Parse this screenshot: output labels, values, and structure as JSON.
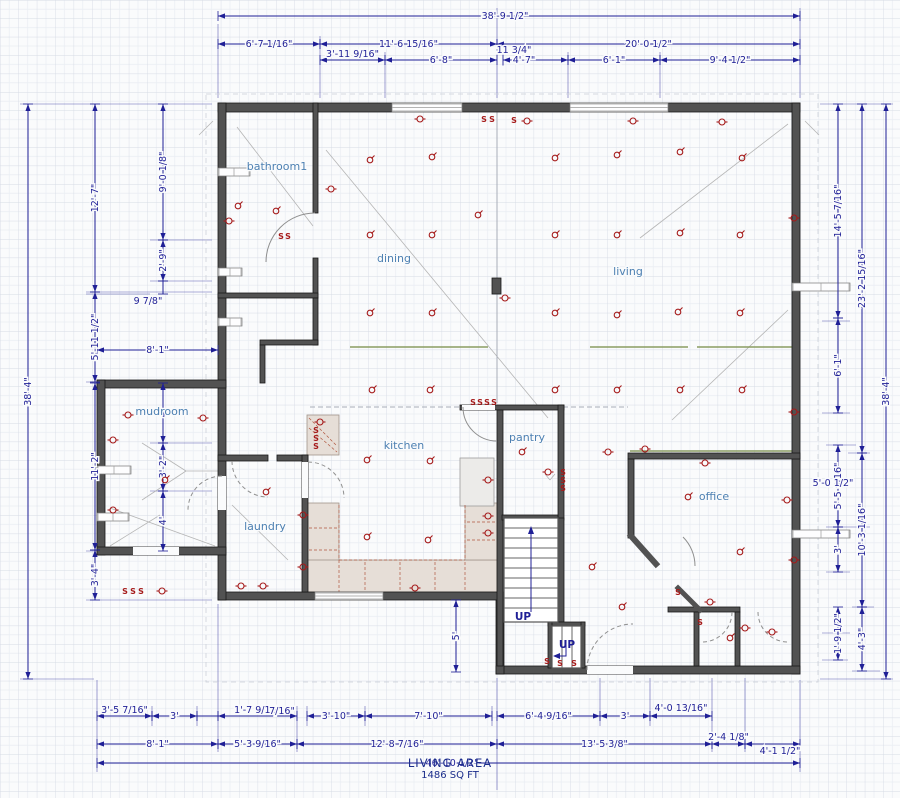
{
  "footer": {
    "area_label": "LIVING AREA",
    "area_sqft": "1486 SQ FT"
  },
  "colors": {
    "background": "#fafbfc",
    "dimension": "#1f1f96",
    "wall": "#525252",
    "room_label": "#4d80b2",
    "electrical": "#a51a1a",
    "beam_olive": "#8a9c62",
    "counter": "#e6ded7",
    "footer_navy": "#1c2e8c",
    "grid_minor": "#e9edf3",
    "grid_major": "#d6dbe5"
  },
  "rooms": [
    {
      "t": "bathroom1",
      "x": 277,
      "y": 170
    },
    {
      "t": "dining",
      "x": 394,
      "y": 262
    },
    {
      "t": "living",
      "x": 628,
      "y": 275
    },
    {
      "t": "mudroom",
      "x": 162,
      "y": 415
    },
    {
      "t": "kitchen",
      "x": 404,
      "y": 449
    },
    {
      "t": "pantry",
      "x": 527,
      "y": 441
    },
    {
      "t": "laundry",
      "x": 265,
      "y": 530
    },
    {
      "t": "office",
      "x": 714,
      "y": 500
    }
  ],
  "up_labels": [
    {
      "t": "UP",
      "x": 523,
      "y": 620
    },
    {
      "t": "UP",
      "x": 567,
      "y": 648
    }
  ],
  "dims_h": [
    {
      "l": "38'-9 1/2\"",
      "x1": 218,
      "x2": 800,
      "y": 16,
      "lx": 505
    },
    {
      "l": "6'-7 1/16\"",
      "x1": 218,
      "x2": 320,
      "y": 44
    },
    {
      "l": "11'-6 15/16\"",
      "x1": 320,
      "x2": 497,
      "y": 44
    },
    {
      "l": "20'-0 1/2\"",
      "x1": 497,
      "x2": 800,
      "y": 44
    },
    {
      "l": "3'-11 9/16\"",
      "x1": 320,
      "x2": 385,
      "y": 60,
      "ly": 54
    },
    {
      "l": "6'-8\"",
      "x1": 385,
      "x2": 497,
      "y": 60
    },
    {
      "l": "",
      "x1": 503,
      "x2": 568,
      "y": 60
    },
    {
      "l": "6'-1\"",
      "x1": 568,
      "x2": 660,
      "y": 60
    },
    {
      "l": "9'-4 1/2\"",
      "x1": 660,
      "x2": 800,
      "y": 60
    },
    {
      "l": "8'-1\"",
      "x1": 97,
      "x2": 218,
      "y": 350
    },
    {
      "l": "3'-5 7/16\"",
      "x1": 97,
      "x2": 152,
      "y": 716,
      "ly": 710
    },
    {
      "l": "3'",
      "x1": 152,
      "x2": 197,
      "y": 716
    },
    {
      "l": "",
      "x1": 197,
      "x2": 218,
      "y": 716
    },
    {
      "l": "1'-7 9/16\"",
      "x1": 218,
      "x2": 297,
      "y": 716,
      "ly": 710
    },
    {
      "l": "3'-10\"",
      "x1": 307,
      "x2": 365,
      "y": 716
    },
    {
      "l": "7'-10\"",
      "x1": 365,
      "x2": 492,
      "y": 716
    },
    {
      "l": "6'-4 9/16\"",
      "x1": 497,
      "x2": 600,
      "y": 716
    },
    {
      "l": "3'",
      "x1": 600,
      "x2": 650,
      "y": 716
    },
    {
      "l": "4'-0 13/16\"",
      "x1": 650,
      "x2": 712,
      "y": 716,
      "ly": 708
    },
    {
      "l": "8'-1\"",
      "x1": 97,
      "x2": 218,
      "y": 744
    },
    {
      "l": "5'-3 9/16\"",
      "x1": 218,
      "x2": 297,
      "y": 744
    },
    {
      "l": "12'-8 7/16\"",
      "x1": 297,
      "x2": 497,
      "y": 744
    },
    {
      "l": "13'-5 3/8\"",
      "x1": 497,
      "x2": 712,
      "y": 744
    },
    {
      "l": "2'-4 1/8\"",
      "x1": 712,
      "x2": 745,
      "y": 744,
      "ly": 737
    },
    {
      "l": "4'-1 1/2\"",
      "x1": 745,
      "x2": 800,
      "y": 744,
      "lx": 780,
      "ly": 751
    },
    {
      "l": "46'-10 1/2\"",
      "x1": 97,
      "x2": 800,
      "y": 763,
      "lx": 452
    }
  ],
  "dims_v": [
    {
      "l": "38'-4\"",
      "y1": 104,
      "y2": 679,
      "x": 28
    },
    {
      "l": "12'-7\"",
      "y1": 104,
      "y2": 292,
      "x": 95
    },
    {
      "l": "5'-11 1/2\"",
      "y1": 292,
      "y2": 382,
      "x": 95
    },
    {
      "l": "11'-2\"",
      "y1": 383,
      "y2": 550,
      "x": 95
    },
    {
      "l": "3'-4\"",
      "y1": 550,
      "y2": 600,
      "x": 95
    },
    {
      "l": "9'-0 1/8\"",
      "y1": 104,
      "y2": 240,
      "x": 163
    },
    {
      "l": "2'-9\"",
      "y1": 240,
      "y2": 281,
      "x": 163
    },
    {
      "l": "",
      "y1": 281,
      "y2": 294,
      "x": 163
    },
    {
      "l": "4'",
      "y1": 383,
      "y2": 443,
      "x": 163
    },
    {
      "l": "3'-2\"",
      "y1": 443,
      "y2": 491,
      "x": 163
    },
    {
      "l": "4'",
      "y1": 491,
      "y2": 551,
      "x": 163
    },
    {
      "l": "5'",
      "y1": 600,
      "y2": 672,
      "x": 456
    },
    {
      "l": "14'-5 7/16\"",
      "y1": 104,
      "y2": 318,
      "x": 838
    },
    {
      "l": "6'-1\"",
      "y1": 318,
      "y2": 413,
      "x": 838
    },
    {
      "l": "5'-5 9/16\"",
      "y1": 445,
      "y2": 527,
      "x": 838
    },
    {
      "l": "3'",
      "y1": 527,
      "y2": 572,
      "x": 838
    },
    {
      "l": "1'-9 1/2\"",
      "y1": 607,
      "y2": 660,
      "x": 838
    },
    {
      "l": "23'-2 15/16\"",
      "y1": 104,
      "y2": 453,
      "x": 862
    },
    {
      "l": "10'-3 1/16\"",
      "y1": 453,
      "y2": 607,
      "x": 862
    },
    {
      "l": "4'-3\"",
      "y1": 607,
      "y2": 671,
      "x": 862
    },
    {
      "l": "38'-4\"",
      "y1": 104,
      "y2": 679,
      "x": 886
    }
  ],
  "dims_free": [
    {
      "t": "11 3/4\"",
      "x": 514,
      "y": 53
    },
    {
      "t": "4'-7\"",
      "x": 524,
      "y": 63
    },
    {
      "t": "7/16\"",
      "x": 282,
      "y": 714
    },
    {
      "t": "9 7/8\"",
      "x": 148,
      "y": 304,
      "rot": -90
    },
    {
      "t": "5'-0 1/2\"",
      "x": 833,
      "y": 486,
      "rot": -90
    }
  ],
  "walls": [
    [
      218,
      103,
      582,
      9
    ],
    [
      792,
      103,
      8,
      571
    ],
    [
      496,
      666,
      304,
      8
    ],
    [
      496,
      596,
      8,
      78
    ],
    [
      218,
      592,
      286,
      8
    ],
    [
      218,
      103,
      8,
      497
    ],
    [
      97,
      380,
      129,
      8
    ],
    [
      97,
      380,
      8,
      175
    ],
    [
      97,
      547,
      129,
      8
    ],
    [
      313,
      103,
      5,
      110
    ],
    [
      313,
      258,
      5,
      40
    ],
    [
      218,
      293,
      100,
      5
    ],
    [
      313,
      298,
      5,
      47
    ],
    [
      260,
      340,
      58,
      5
    ],
    [
      260,
      345,
      5,
      38
    ],
    [
      492,
      278,
      9,
      16
    ],
    [
      460,
      405,
      104,
      5
    ],
    [
      497,
      410,
      6,
      256
    ],
    [
      558,
      405,
      6,
      115
    ],
    [
      558,
      518,
      6,
      104
    ],
    [
      502,
      515,
      56,
      5
    ],
    [
      218,
      455,
      50,
      6
    ],
    [
      277,
      455,
      31,
      6
    ],
    [
      302,
      455,
      6,
      137
    ],
    [
      628,
      453,
      172,
      6
    ],
    [
      628,
      459,
      6,
      79
    ],
    [
      668,
      607,
      72,
      5
    ],
    [
      694,
      612,
      5,
      54
    ],
    [
      735,
      612,
      5,
      54
    ],
    [
      548,
      622,
      37,
      4
    ],
    [
      548,
      622,
      4,
      46
    ],
    [
      581,
      622,
      4,
      46
    ]
  ],
  "angled_walls": [
    [
      631,
      536,
      656,
      564,
      6
    ],
    [
      678,
      588,
      700,
      610,
      5
    ]
  ],
  "gaps": [
    [
      133,
      547,
      46,
      8
    ],
    [
      218,
      476,
      8,
      34
    ],
    [
      302,
      462,
      6,
      36
    ],
    [
      462,
      405,
      33,
      5
    ],
    [
      587,
      666,
      46,
      8
    ]
  ],
  "windows": [
    [
      392,
      103,
      70,
      9,
      "h"
    ],
    [
      570,
      103,
      98,
      9,
      "h"
    ],
    [
      315,
      592,
      68,
      8,
      "h"
    ],
    [
      218,
      168,
      8,
      32,
      "v"
    ],
    [
      218,
      268,
      8,
      24,
      "v"
    ],
    [
      218,
      318,
      8,
      24,
      "v"
    ],
    [
      97,
      466,
      8,
      34,
      "v"
    ],
    [
      97,
      513,
      8,
      32,
      "v"
    ],
    [
      792,
      283,
      8,
      58,
      "v"
    ],
    [
      792,
      530,
      8,
      58,
      "v"
    ]
  ],
  "door_arcs": [
    {
      "d": "M 315 213 A 49 49 0 0 0 266 262",
      "dash": false
    },
    {
      "d": "M 222 476 A 34 34 0 0 0 188 510",
      "dash": true
    },
    {
      "d": "M 232 461 A 36 36 0 0 0 268 497",
      "dash": true
    },
    {
      "d": "M 308 462 A 36 36 0 0 1 344 498",
      "dash": true
    },
    {
      "d": "M 463 407 A 34 34 0 0 0 497 441",
      "dash": false
    },
    {
      "d": "M 587 670 A 46 46 0 0 1 633 624",
      "dash": true
    },
    {
      "d": "M 683 537 A 41 41 0 0 1 695 566",
      "dash": false
    },
    {
      "d": "M 732 612 A 30 30 0 0 1 702 642",
      "dash": true
    },
    {
      "d": "M 758 612 A 30 30 0 0 0 788 642",
      "dash": true
    }
  ],
  "counters": {
    "rects": [
      [
        307,
        415,
        32,
        40
      ],
      [
        307,
        503,
        32,
        89
      ],
      [
        307,
        560,
        190,
        32
      ],
      [
        465,
        503,
        32,
        57
      ]
    ],
    "appliance": [
      460,
      458,
      34,
      48
    ],
    "lines": [
      [
        339,
        505,
        339,
        592
      ],
      [
        339,
        560,
        465,
        560
      ],
      [
        365,
        562,
        365,
        590
      ],
      [
        400,
        562,
        400,
        590
      ],
      [
        435,
        562,
        435,
        590
      ],
      [
        465,
        562,
        465,
        590
      ],
      [
        465,
        505,
        465,
        560
      ],
      [
        467,
        522,
        495,
        522
      ],
      [
        467,
        540,
        495,
        540
      ],
      [
        309,
        528,
        337,
        528
      ],
      [
        309,
        550,
        337,
        550
      ]
    ],
    "hatch": [
      [
        309,
        418,
        337,
        446
      ],
      [
        309,
        428,
        337,
        452
      ]
    ]
  },
  "stairs": {
    "main": {
      "x": 504,
      "y": 518,
      "w": 54,
      "h": 104,
      "treads": 9
    },
    "small": {
      "x": 552,
      "y": 626,
      "w": 29,
      "h": 42
    }
  },
  "beams": [
    [
      350,
      347,
      488,
      347
    ],
    [
      590,
      347,
      688,
      347
    ],
    [
      697,
      347,
      793,
      347
    ],
    [
      630,
      451,
      793,
      451
    ]
  ],
  "diagonals": [
    [
      237,
      127,
      313,
      226
    ],
    [
      326,
      150,
      548,
      418
    ],
    [
      640,
      238,
      788,
      124
    ],
    [
      672,
      420,
      788,
      310
    ],
    [
      142,
      443,
      186,
      471
    ],
    [
      186,
      471,
      224,
      471
    ],
    [
      142,
      500,
      186,
      471
    ],
    [
      110,
      508,
      215,
      546
    ],
    [
      110,
      546,
      160,
      515
    ],
    [
      232,
      505,
      288,
      560
    ],
    [
      545,
      474,
      550,
      480
    ],
    [
      550,
      480,
      555,
      474
    ],
    [
      199,
      135,
      213,
      121
    ],
    [
      805,
      121,
      819,
      135
    ]
  ],
  "thin_lines": [
    [
      497,
      112,
      497,
      403
    ]
  ],
  "thin_dashed": [
    [
      310,
      407,
      460,
      407
    ],
    [
      563,
      407,
      628,
      407
    ]
  ],
  "overhang": [
    206,
    94,
    612,
    588
  ],
  "ext_lines": [
    [
      218,
      24,
      218,
      98
    ],
    [
      320,
      36,
      320,
      98
    ],
    [
      385,
      52,
      385,
      98
    ],
    [
      497,
      8,
      497,
      98
    ],
    [
      568,
      52,
      568,
      98
    ],
    [
      660,
      52,
      660,
      98
    ],
    [
      800,
      8,
      800,
      98
    ],
    [
      503,
      52,
      503,
      66
    ],
    [
      97,
      680,
      97,
      772
    ],
    [
      152,
      706,
      152,
      726
    ],
    [
      197,
      706,
      197,
      726
    ],
    [
      218,
      604,
      218,
      752
    ],
    [
      297,
      706,
      297,
      752
    ],
    [
      307,
      706,
      307,
      726
    ],
    [
      365,
      706,
      365,
      726
    ],
    [
      492,
      706,
      492,
      726
    ],
    [
      497,
      678,
      497,
      790
    ],
    [
      600,
      678,
      600,
      726
    ],
    [
      650,
      678,
      650,
      726
    ],
    [
      712,
      678,
      712,
      752
    ],
    [
      745,
      678,
      745,
      752
    ],
    [
      800,
      680,
      800,
      772
    ],
    [
      20,
      104,
      212,
      104
    ],
    [
      150,
      240,
      212,
      240
    ],
    [
      150,
      281,
      212,
      281
    ],
    [
      86,
      292,
      212,
      292
    ],
    [
      86,
      294,
      150,
      294
    ],
    [
      86,
      382,
      212,
      382
    ],
    [
      150,
      443,
      212,
      443
    ],
    [
      150,
      491,
      212,
      491
    ],
    [
      86,
      551,
      212,
      551
    ],
    [
      86,
      600,
      212,
      600
    ],
    [
      20,
      679,
      94,
      679
    ],
    [
      150,
      383,
      212,
      383
    ],
    [
      820,
      104,
      893,
      104
    ],
    [
      822,
      321,
      850,
      321
    ],
    [
      822,
      413,
      850,
      413
    ],
    [
      826,
      445,
      856,
      445
    ],
    [
      826,
      527,
      870,
      527
    ],
    [
      826,
      572,
      850,
      572
    ],
    [
      852,
      607,
      874,
      607
    ],
    [
      822,
      633,
      850,
      633
    ],
    [
      852,
      671,
      880,
      671
    ],
    [
      820,
      679,
      893,
      679
    ],
    [
      848,
      453,
      870,
      453
    ],
    [
      822,
      660,
      848,
      660
    ]
  ],
  "symbols": {
    "lights": [
      [
        370,
        160
      ],
      [
        432,
        157
      ],
      [
        370,
        235
      ],
      [
        432,
        235
      ],
      [
        370,
        313
      ],
      [
        432,
        313
      ],
      [
        372,
        390
      ],
      [
        430,
        390
      ],
      [
        478,
        215
      ],
      [
        555,
        158
      ],
      [
        617,
        155
      ],
      [
        680,
        152
      ],
      [
        742,
        158
      ],
      [
        555,
        235
      ],
      [
        617,
        235
      ],
      [
        680,
        233
      ],
      [
        740,
        235
      ],
      [
        555,
        313
      ],
      [
        617,
        315
      ],
      [
        678,
        312
      ],
      [
        740,
        313
      ],
      [
        555,
        390
      ],
      [
        617,
        390
      ],
      [
        680,
        390
      ],
      [
        742,
        390
      ],
      [
        238,
        206
      ],
      [
        276,
        211
      ],
      [
        165,
        480
      ],
      [
        266,
        492
      ],
      [
        367,
        460
      ],
      [
        430,
        461
      ],
      [
        367,
        537
      ],
      [
        428,
        540
      ],
      [
        522,
        452
      ],
      [
        592,
        567
      ],
      [
        622,
        607
      ],
      [
        688,
        497
      ],
      [
        740,
        552
      ],
      [
        730,
        638
      ]
    ],
    "outlets": [
      [
        420,
        119
      ],
      [
        527,
        121
      ],
      [
        633,
        121
      ],
      [
        722,
        122
      ],
      [
        229,
        221
      ],
      [
        331,
        189
      ],
      [
        505,
        298
      ],
      [
        794,
        218
      ],
      [
        794,
        412
      ],
      [
        794,
        560
      ],
      [
        128,
        415
      ],
      [
        203,
        418
      ],
      [
        113,
        440
      ],
      [
        113,
        510
      ],
      [
        162,
        591
      ],
      [
        241,
        586
      ],
      [
        263,
        586
      ],
      [
        415,
        588
      ],
      [
        320,
        422
      ],
      [
        488,
        480
      ],
      [
        488,
        516
      ],
      [
        488,
        533
      ],
      [
        303,
        515
      ],
      [
        303,
        567
      ],
      [
        548,
        472
      ],
      [
        645,
        449
      ],
      [
        705,
        463
      ],
      [
        608,
        452
      ],
      [
        787,
        500
      ],
      [
        710,
        602
      ],
      [
        745,
        628
      ],
      [
        772,
        632
      ]
    ],
    "switches": [
      [
        484,
        119
      ],
      [
        492,
        119
      ],
      [
        514,
        120
      ],
      [
        281,
        236
      ],
      [
        288,
        236
      ],
      [
        125,
        591
      ],
      [
        133,
        591
      ],
      [
        141,
        591
      ],
      [
        316,
        430
      ],
      [
        316,
        438
      ],
      [
        316,
        446
      ],
      [
        473,
        402
      ],
      [
        480,
        402
      ],
      [
        487,
        402
      ],
      [
        494,
        402
      ],
      [
        563,
        472
      ],
      [
        563,
        480
      ],
      [
        563,
        488
      ],
      [
        547,
        661
      ],
      [
        560,
        663
      ],
      [
        574,
        663
      ],
      [
        678,
        592
      ],
      [
        700,
        622
      ]
    ]
  }
}
